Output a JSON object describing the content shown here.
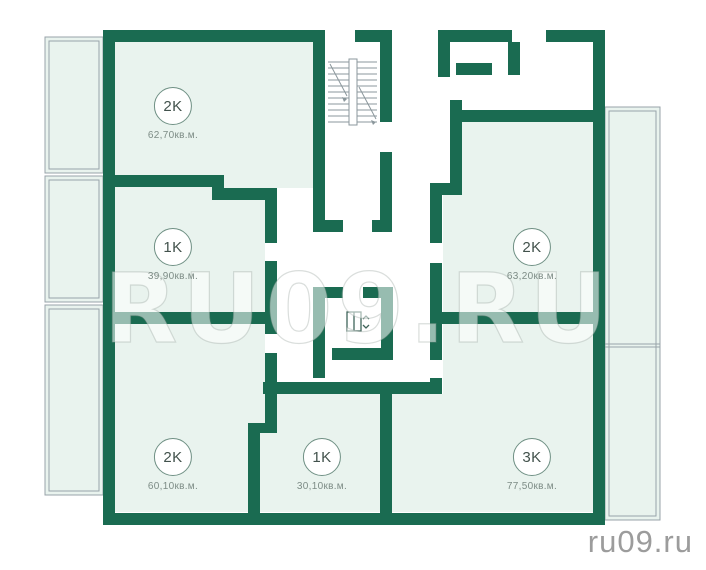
{
  "apartments": [
    {
      "code": "2K",
      "area": "62,70кв.м."
    },
    {
      "code": "1K",
      "area": "39,90кв.м."
    },
    {
      "code": "2K",
      "area": "63,20кв.м."
    },
    {
      "code": "2K",
      "area": "60,10кв.м."
    },
    {
      "code": "1K",
      "area": "30,10кв.м."
    },
    {
      "code": "3K",
      "area": "77,50кв.м."
    }
  ],
  "watermark": {
    "center": "RU09.RU",
    "corner": "ru09.ru"
  },
  "icons": {
    "elevator": "elevator-icon",
    "stairs": "stairs-icon"
  },
  "colors": {
    "wall": "#1a6b51",
    "room": "#e9f3ee",
    "balcony_outline": "#98a3a9",
    "accent_circle": "#6f9084"
  }
}
